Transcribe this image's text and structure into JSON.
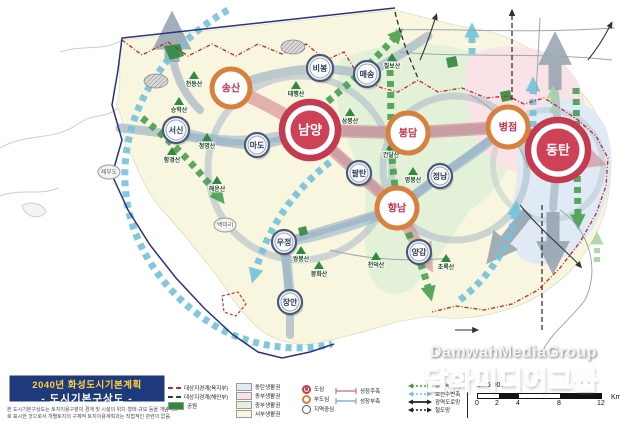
{
  "title_box": {
    "line1": "2040년 화성도시기본계획",
    "line2": "- 도시기본구상도 -"
  },
  "disclaimer": "본 도시기본구상도는 토지이용구분의 경계 및 시설의 위치·형태·규모 등을 개념적으로 표시한 것으로서 개별토지의 구체적 토지이용계획과는 직접적인 관련이 없음.",
  "watermark": {
    "latin": "DamwahMediaGroup",
    "korean": "담화미디어그룹"
  },
  "legend": {
    "boundaries": [
      {
        "label": "대상지경계(육지부)",
        "color": "#c0272d"
      },
      {
        "label": "대상지경계(해안부)",
        "color": "#28337f"
      },
      {
        "label": "공원",
        "color": "#2e8b3e"
      }
    ],
    "zones": [
      {
        "label": "동탄생활권",
        "color": "#dfeaf4"
      },
      {
        "label": "동부생활권",
        "color": "#fae3e6"
      },
      {
        "label": "중부생활권",
        "color": "#e4f1d9"
      },
      {
        "label": "서부생활권",
        "color": "#f9f6df"
      }
    ],
    "centers": [
      {
        "label": "도심",
        "ring": "#c43a50",
        "core": "#ce4257"
      },
      {
        "label": "부도심",
        "ring": "#d8803e",
        "core": "#ffffff"
      },
      {
        "label": "지역중심",
        "ring": "#4a5a78",
        "core": "#ffffff"
      }
    ],
    "axes": [
      {
        "label": "성장주축",
        "color": "#d4848c"
      },
      {
        "label": "성장부축",
        "color": "#8fb0c9"
      }
    ],
    "networks": [
      {
        "label": "보전녹지축",
        "color": "#3f9b49"
      },
      {
        "label": "보전수변축",
        "color": "#74c2da"
      },
      {
        "label": "광역도로망",
        "color": "#222222"
      },
      {
        "label": "철도망",
        "color": "#222222"
      }
    ]
  },
  "scale": {
    "ratio": "1:75,000",
    "ticks": [
      "0",
      "2",
      "4",
      "8",
      "12"
    ],
    "unit": "Km"
  },
  "map": {
    "cities": [
      {
        "name": "남양",
        "type": "docim",
        "x": 310,
        "y": 130,
        "r": 28
      },
      {
        "name": "동탄",
        "type": "docim",
        "x": 558,
        "y": 150,
        "r": 30
      },
      {
        "name": "송산",
        "type": "budocim",
        "x": 231,
        "y": 88,
        "r": 19
      },
      {
        "name": "봉담",
        "type": "budocim",
        "x": 408,
        "y": 133,
        "r": 20
      },
      {
        "name": "병점",
        "type": "budocim",
        "x": 508,
        "y": 127,
        "r": 20
      },
      {
        "name": "향남",
        "type": "budocim",
        "x": 397,
        "y": 208,
        "r": 20
      },
      {
        "name": "서신",
        "type": "jiyeok",
        "x": 176,
        "y": 130,
        "r": 13
      },
      {
        "name": "마도",
        "type": "jiyeok",
        "x": 257,
        "y": 145,
        "r": 12
      },
      {
        "name": "비봉",
        "type": "jiyeok",
        "x": 320,
        "y": 68,
        "r": 13
      },
      {
        "name": "매송",
        "type": "jiyeok",
        "x": 367,
        "y": 74,
        "r": 13
      },
      {
        "name": "팔탄",
        "type": "jiyeok",
        "x": 359,
        "y": 173,
        "r": 12
      },
      {
        "name": "정남",
        "type": "jiyeok",
        "x": 440,
        "y": 176,
        "r": 12
      },
      {
        "name": "양감",
        "type": "jiyeok",
        "x": 419,
        "y": 252,
        "r": 12
      },
      {
        "name": "우정",
        "type": "jiyeok",
        "x": 284,
        "y": 242,
        "r": 12
      },
      {
        "name": "장안",
        "type": "jiyeok",
        "x": 290,
        "y": 302,
        "r": 12
      }
    ],
    "badges": [
      {
        "name": "제부도",
        "x": 109,
        "y": 172
      },
      {
        "name": "백미리",
        "x": 225,
        "y": 225
      }
    ],
    "mountains": [
      {
        "name": "칠보산",
        "x": 392,
        "y": 58
      },
      {
        "name": "천등산",
        "x": 194,
        "y": 76
      },
      {
        "name": "태행산",
        "x": 296,
        "y": 86
      },
      {
        "name": "승학산",
        "x": 179,
        "y": 102
      },
      {
        "name": "삼봉산",
        "x": 350,
        "y": 113
      },
      {
        "name": "무봉산",
        "x": 524,
        "y": 124
      },
      {
        "name": "청명산",
        "x": 207,
        "y": 138
      },
      {
        "name": "건달산",
        "x": 391,
        "y": 147
      },
      {
        "name": "함경산",
        "x": 172,
        "y": 152
      },
      {
        "name": "명봉산",
        "x": 413,
        "y": 172
      },
      {
        "name": "해운산",
        "x": 217,
        "y": 181
      },
      {
        "name": "쌍봉산",
        "x": 301,
        "y": 251
      },
      {
        "name": "천덕산",
        "x": 376,
        "y": 257
      },
      {
        "name": "초록산",
        "x": 446,
        "y": 259
      },
      {
        "name": "봉화산",
        "x": 319,
        "y": 266
      }
    ]
  }
}
